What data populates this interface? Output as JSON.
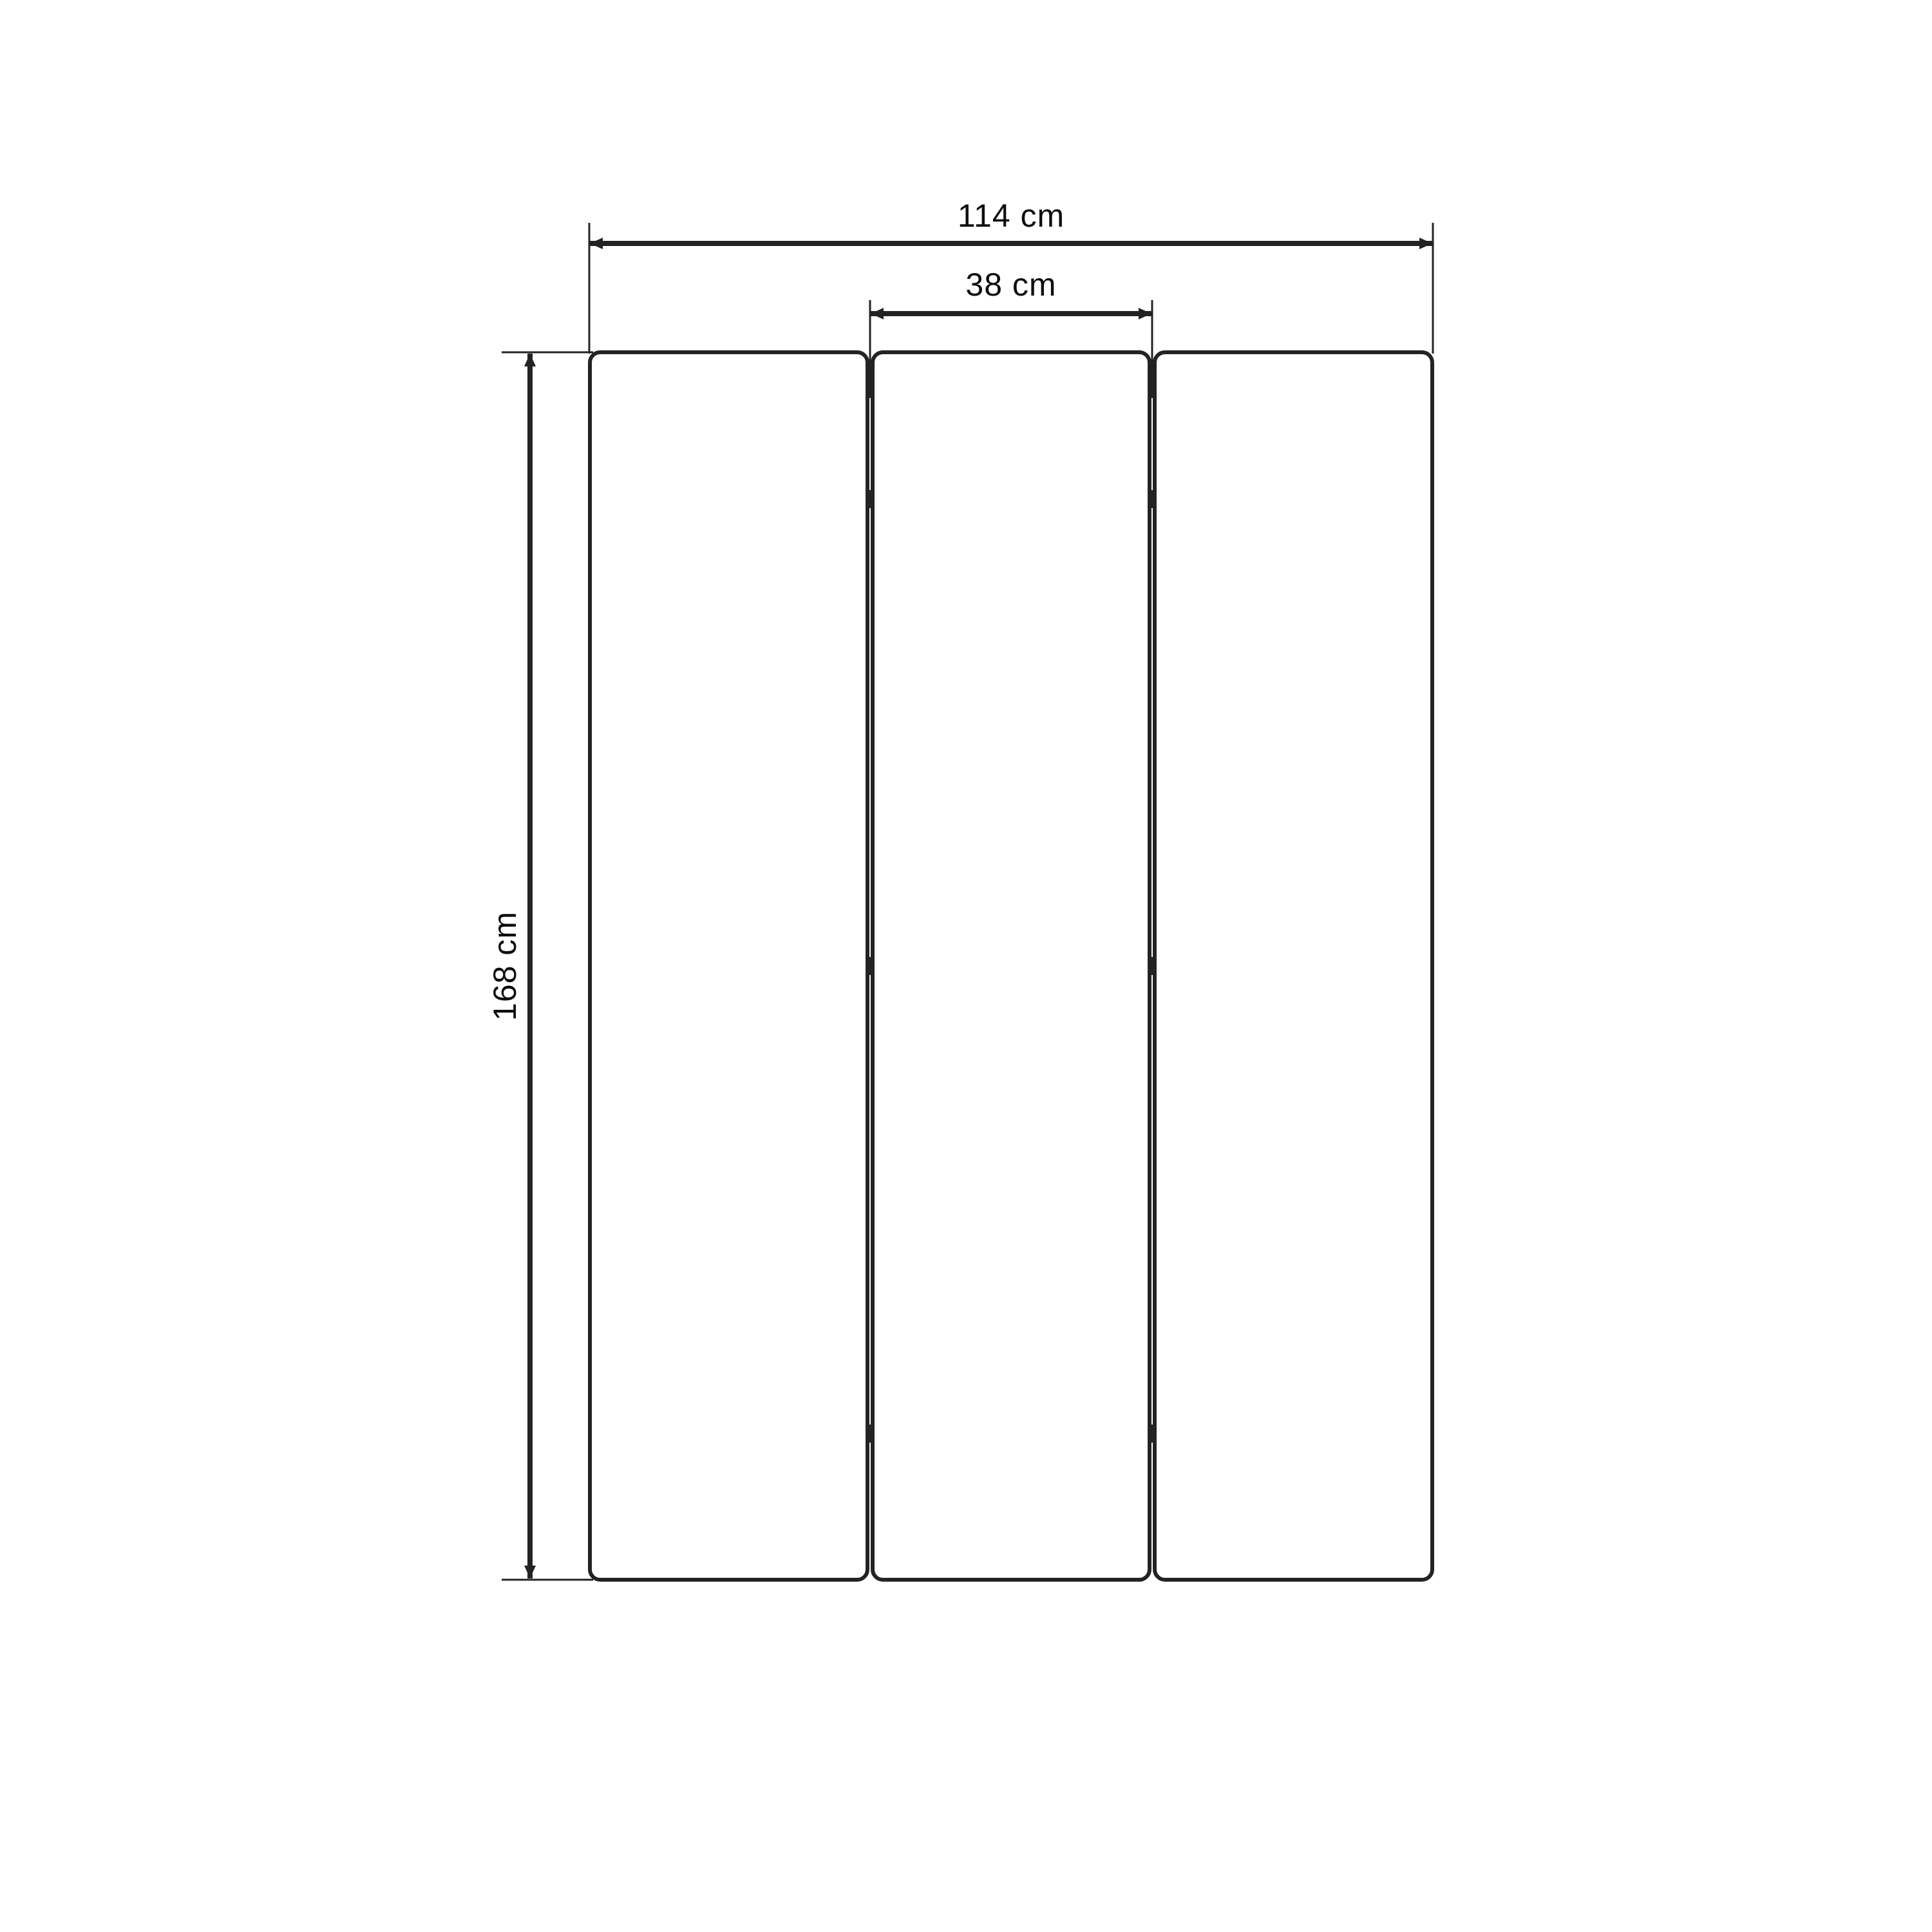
{
  "meta": {
    "type": "technical-dimension-drawing",
    "subject": "three-panel folding screen, front elevation",
    "units": "cm"
  },
  "dimensions": {
    "total_width": {
      "label": "114 cm",
      "value": 114
    },
    "panel_width": {
      "label": "38 cm",
      "value": 38
    },
    "height": {
      "label": "168 cm",
      "value": 168
    }
  },
  "structure": {
    "panel_count": 3,
    "gap_count": 2,
    "hinges_per_gap": 3
  },
  "colors": {
    "background": "#ffffff",
    "line": "#232323",
    "text": "#0d0d0d"
  }
}
